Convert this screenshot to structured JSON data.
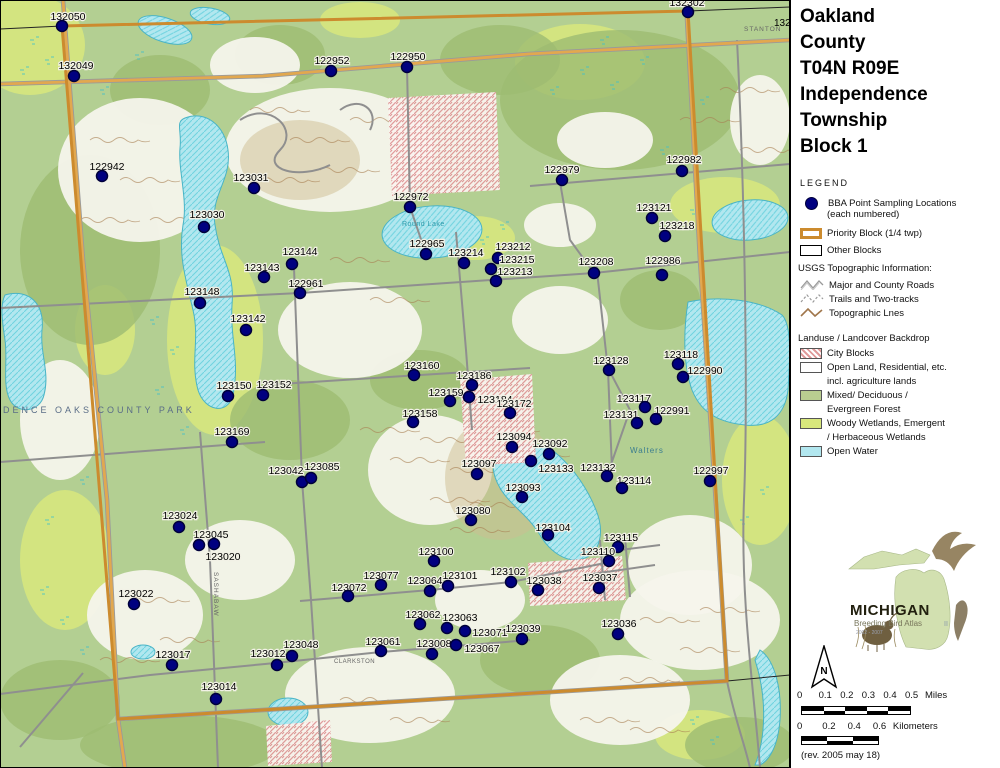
{
  "title": {
    "lines": [
      "Oakland",
      "County",
      "T04N R09E",
      "Independence",
      "Township",
      "Block 1"
    ]
  },
  "legend": {
    "heading": "LEGEND",
    "usgs_heading": "USGS Topographic Information:",
    "landuse_heading": "Landuse / Landcover Backdrop",
    "items": [
      {
        "id": "bba-points",
        "line1": "BBA Point Sampling Locations",
        "line2": "(each numbered)"
      },
      {
        "id": "priority-block",
        "line1": "Priority Block (1/4 twp)"
      },
      {
        "id": "other-blocks",
        "line1": "Other Blocks"
      },
      {
        "id": "major-roads",
        "line1": "Major and County Roads"
      },
      {
        "id": "trails",
        "line1": "Trails and Two-tracks"
      },
      {
        "id": "topo-lines",
        "line1": "Topographic Lnes"
      },
      {
        "id": "city-blocks",
        "line1": "City Blocks"
      },
      {
        "id": "open-land",
        "line1": "Open Land, Residential, etc.",
        "line2": "incl. agriculture lands"
      },
      {
        "id": "forest",
        "line1": "Mixed/ Deciduous /",
        "line2": "Evergreen Forest"
      },
      {
        "id": "wetlands",
        "line1": "Woody Wetlands, Emergent",
        "line2": "/ Herbaceous Wetlands"
      },
      {
        "id": "open-water",
        "line1": "Open Water"
      }
    ]
  },
  "logo": {
    "name": "MICHIGAN",
    "subtitle": "Breeding Bird Atlas",
    "years": "2002 - 2007",
    "numeral": "II"
  },
  "north_arrow": "N",
  "scalebars": {
    "miles": {
      "ticks": [
        "0",
        "0.1",
        "0.2",
        "0.3",
        "0.4",
        "0.5"
      ],
      "unit": "Miles"
    },
    "kilometers": {
      "ticks": [
        "0",
        "0.2",
        "0.4",
        "0.6"
      ],
      "unit": "Kilometers"
    }
  },
  "revision": "(rev. 2005 may 18)",
  "colors": {
    "point": "#000080",
    "point_ring": "#00003a",
    "priority_border": "#cc8b2e",
    "water": "#b2e7ef",
    "water_line": "#49b4c6",
    "forest": "#b3cf92",
    "forest_dark": "#9dbb72",
    "wetland": "#d8e87c",
    "open_land": "#f6f4ec",
    "city_hatch": "#e09a9a",
    "contour": "#a87f52",
    "road_major": "#e2a84f",
    "road_minor": "#8f8f8f",
    "label": "#000000"
  },
  "map": {
    "small_labels": [
      {
        "text": "INDEPENDENCE OAKS COUNTY PARK",
        "x": -58,
        "y": 413,
        "size": 9,
        "color": "#5a6d87",
        "spacing": 3,
        "rot": 0
      },
      {
        "text": "Walters",
        "x": 630,
        "y": 453,
        "size": 8,
        "color": "#3a7d8f",
        "spacing": 1,
        "rot": 0
      },
      {
        "text": "Round Lake",
        "x": 402,
        "y": 226,
        "size": 7,
        "color": "#2e9aab",
        "spacing": 0.5,
        "rot": 0
      },
      {
        "text": "STANTON",
        "x": 744,
        "y": 31,
        "size": 6.5,
        "color": "#666666",
        "spacing": 1,
        "rot": 0
      },
      {
        "text": "CLARKSTON",
        "x": 334,
        "y": 663,
        "size": 6,
        "color": "#666666",
        "spacing": 0.5,
        "rot": 0
      },
      {
        "text": "SASHABAW",
        "x": 214,
        "y": 572,
        "size": 6.5,
        "color": "#666666",
        "spacing": 1,
        "rot": 90
      },
      {
        "text": "132",
        "x": 774,
        "y": 26,
        "size": 10,
        "color": "#000000",
        "spacing": 0,
        "rot": 0
      }
    ],
    "points": [
      {
        "id": "132050",
        "x": 62,
        "y": 26,
        "lx": 68,
        "ly": 20
      },
      {
        "id": "132049",
        "x": 74,
        "y": 76,
        "lx": 76,
        "ly": 69
      },
      {
        "id": "122942",
        "x": 102,
        "y": 176,
        "lx": 107,
        "ly": 170
      },
      {
        "id": "123031",
        "x": 254,
        "y": 188,
        "lx": 251,
        "ly": 181
      },
      {
        "id": "123030",
        "x": 204,
        "y": 227,
        "lx": 207,
        "ly": 218
      },
      {
        "id": "122952",
        "x": 331,
        "y": 71,
        "lx": 332,
        "ly": 64
      },
      {
        "id": "122950",
        "x": 407,
        "y": 67,
        "lx": 408,
        "ly": 60
      },
      {
        "id": "132302",
        "x": 688,
        "y": 12,
        "lx": 687,
        "ly": 6
      },
      {
        "id": "122972",
        "x": 410,
        "y": 207,
        "lx": 411,
        "ly": 200
      },
      {
        "id": "122979",
        "x": 562,
        "y": 180,
        "lx": 562,
        "ly": 173
      },
      {
        "id": "122982",
        "x": 682,
        "y": 171,
        "lx": 684,
        "ly": 163
      },
      {
        "id": "123121",
        "x": 652,
        "y": 218,
        "lx": 654,
        "ly": 211
      },
      {
        "id": "123218",
        "x": 665,
        "y": 236,
        "lx": 677,
        "ly": 229
      },
      {
        "id": "122965",
        "x": 426,
        "y": 254,
        "lx": 427,
        "ly": 247
      },
      {
        "id": "123214",
        "x": 464,
        "y": 263,
        "lx": 466,
        "ly": 256
      },
      {
        "id": "123212",
        "x": 498,
        "y": 258,
        "lx": 513,
        "ly": 250
      },
      {
        "id": "123215",
        "x": 491,
        "y": 269,
        "lx": 517,
        "ly": 263
      },
      {
        "id": "123213",
        "x": 496,
        "y": 281,
        "lx": 515,
        "ly": 275
      },
      {
        "id": "123208",
        "x": 594,
        "y": 273,
        "lx": 596,
        "ly": 265
      },
      {
        "id": "122986",
        "x": 662,
        "y": 275,
        "lx": 663,
        "ly": 264
      },
      {
        "id": "123144",
        "x": 292,
        "y": 264,
        "lx": 300,
        "ly": 255
      },
      {
        "id": "123143",
        "x": 264,
        "y": 277,
        "lx": 262,
        "ly": 271
      },
      {
        "id": "122961",
        "x": 300,
        "y": 293,
        "lx": 306,
        "ly": 287
      },
      {
        "id": "123148",
        "x": 200,
        "y": 303,
        "lx": 202,
        "ly": 295
      },
      {
        "id": "123142",
        "x": 246,
        "y": 330,
        "lx": 248,
        "ly": 322
      },
      {
        "id": "123150",
        "x": 228,
        "y": 396,
        "lx": 234,
        "ly": 389
      },
      {
        "id": "123152",
        "x": 263,
        "y": 395,
        "lx": 274,
        "ly": 388
      },
      {
        "id": "123169",
        "x": 232,
        "y": 442,
        "lx": 232,
        "ly": 435
      },
      {
        "id": "123160",
        "x": 414,
        "y": 375,
        "lx": 422,
        "ly": 369
      },
      {
        "id": "123186",
        "x": 472,
        "y": 385,
        "lx": 474,
        "ly": 379
      },
      {
        "id": "123159",
        "x": 450,
        "y": 401,
        "lx": 446,
        "ly": 396
      },
      {
        "id": "123184",
        "x": 469,
        "y": 397,
        "lx": 495,
        "ly": 403
      },
      {
        "id": "123172",
        "x": 510,
        "y": 413,
        "lx": 514,
        "ly": 407
      },
      {
        "id": "123158",
        "x": 413,
        "y": 422,
        "lx": 420,
        "ly": 417
      },
      {
        "id": "123128",
        "x": 609,
        "y": 370,
        "lx": 611,
        "ly": 364
      },
      {
        "id": "123118",
        "x": 678,
        "y": 364,
        "lx": 681,
        "ly": 358
      },
      {
        "id": "122990",
        "x": 683,
        "y": 377,
        "lx": 705,
        "ly": 374
      },
      {
        "id": "123117",
        "x": 645,
        "y": 407,
        "lx": 634,
        "ly": 402
      },
      {
        "id": "123131",
        "x": 637,
        "y": 423,
        "lx": 621,
        "ly": 418
      },
      {
        "id": "122991",
        "x": 656,
        "y": 419,
        "lx": 672,
        "ly": 414
      },
      {
        "id": "123092",
        "x": 549,
        "y": 454,
        "lx": 550,
        "ly": 447
      },
      {
        "id": "123094",
        "x": 512,
        "y": 447,
        "lx": 514,
        "ly": 440
      },
      {
        "id": "123097",
        "x": 477,
        "y": 474,
        "lx": 479,
        "ly": 467
      },
      {
        "id": "123133",
        "x": 531,
        "y": 461,
        "lx": 556,
        "ly": 472
      },
      {
        "id": "123093",
        "x": 522,
        "y": 497,
        "lx": 523,
        "ly": 491
      },
      {
        "id": "123080",
        "x": 471,
        "y": 520,
        "lx": 473,
        "ly": 514
      },
      {
        "id": "123104",
        "x": 548,
        "y": 535,
        "lx": 553,
        "ly": 531
      },
      {
        "id": "123100",
        "x": 434,
        "y": 561,
        "lx": 436,
        "ly": 555
      },
      {
        "id": "123042",
        "x": 302,
        "y": 482,
        "lx": 286,
        "ly": 474
      },
      {
        "id": "123085",
        "x": 311,
        "y": 478,
        "lx": 322,
        "ly": 470
      },
      {
        "id": "123024",
        "x": 179,
        "y": 527,
        "lx": 180,
        "ly": 519
      },
      {
        "id": "123045",
        "x": 199,
        "y": 545,
        "lx": 211,
        "ly": 538
      },
      {
        "id": "123020",
        "x": 214,
        "y": 544,
        "lx": 223,
        "ly": 560
      },
      {
        "id": "123022",
        "x": 134,
        "y": 604,
        "lx": 136,
        "ly": 597
      },
      {
        "id": "123017",
        "x": 172,
        "y": 665,
        "lx": 173,
        "ly": 658
      },
      {
        "id": "123012",
        "x": 277,
        "y": 665,
        "lx": 268,
        "ly": 657
      },
      {
        "id": "123048",
        "x": 292,
        "y": 656,
        "lx": 301,
        "ly": 648
      },
      {
        "id": "123014",
        "x": 216,
        "y": 699,
        "lx": 219,
        "ly": 690
      },
      {
        "id": "123077",
        "x": 381,
        "y": 585,
        "lx": 381,
        "ly": 579
      },
      {
        "id": "123072",
        "x": 348,
        "y": 596,
        "lx": 349,
        "ly": 591
      },
      {
        "id": "123064",
        "x": 430,
        "y": 591,
        "lx": 425,
        "ly": 584
      },
      {
        "id": "123101",
        "x": 448,
        "y": 586,
        "lx": 460,
        "ly": 579
      },
      {
        "id": "123102",
        "x": 511,
        "y": 582,
        "lx": 508,
        "ly": 575
      },
      {
        "id": "123038",
        "x": 538,
        "y": 590,
        "lx": 544,
        "ly": 584
      },
      {
        "id": "123037",
        "x": 599,
        "y": 588,
        "lx": 600,
        "ly": 581
      },
      {
        "id": "123115",
        "x": 618,
        "y": 547,
        "lx": 621,
        "ly": 541
      },
      {
        "id": "123110",
        "x": 609,
        "y": 561,
        "lx": 598,
        "ly": 555
      },
      {
        "id": "123062",
        "x": 420,
        "y": 624,
        "lx": 423,
        "ly": 618
      },
      {
        "id": "123063",
        "x": 447,
        "y": 628,
        "lx": 460,
        "ly": 621
      },
      {
        "id": "123071",
        "x": 465,
        "y": 631,
        "lx": 490,
        "ly": 636
      },
      {
        "id": "123061",
        "x": 381,
        "y": 651,
        "lx": 383,
        "ly": 645
      },
      {
        "id": "123008",
        "x": 432,
        "y": 654,
        "lx": 434,
        "ly": 647
      },
      {
        "id": "123067",
        "x": 456,
        "y": 645,
        "lx": 482,
        "ly": 652
      },
      {
        "id": "123039",
        "x": 522,
        "y": 639,
        "lx": 523,
        "ly": 632
      },
      {
        "id": "123036",
        "x": 618,
        "y": 634,
        "lx": 619,
        "ly": 627
      },
      {
        "id": "123132",
        "x": 607,
        "y": 476,
        "lx": 598,
        "ly": 471
      },
      {
        "id": "123114",
        "x": 622,
        "y": 488,
        "lx": 634,
        "ly": 484
      },
      {
        "id": "122997",
        "x": 710,
        "y": 481,
        "lx": 711,
        "ly": 474
      }
    ]
  }
}
